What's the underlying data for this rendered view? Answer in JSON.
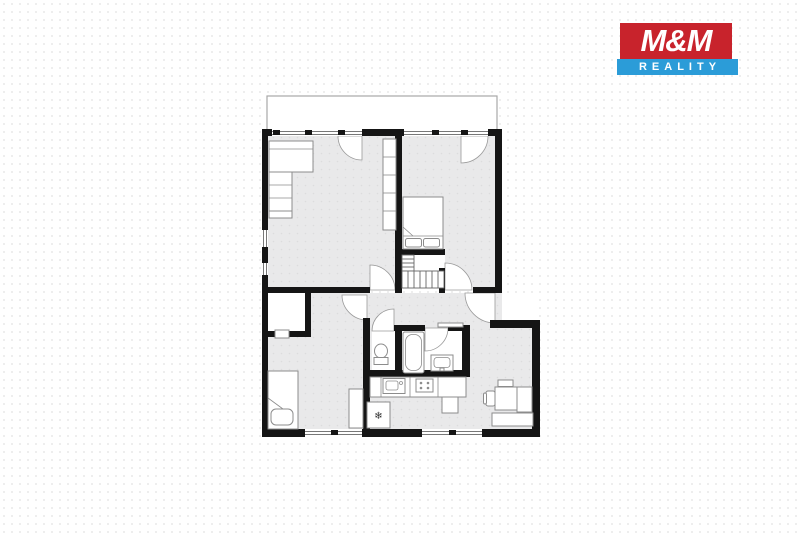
{
  "logo": {
    "line1": "M&M",
    "line2": "REALITY"
  },
  "colors": {
    "logo_red": "#c8232c",
    "logo_blue": "#2b9cd8",
    "logo_text": "#ffffff",
    "wall": "#151515",
    "floor": "#e9e9ea",
    "floor_dot": "#dcdcdd",
    "furniture_stroke": "#8c8c8c",
    "background": "#ffffff",
    "background_dot": "#ededed"
  }
}
